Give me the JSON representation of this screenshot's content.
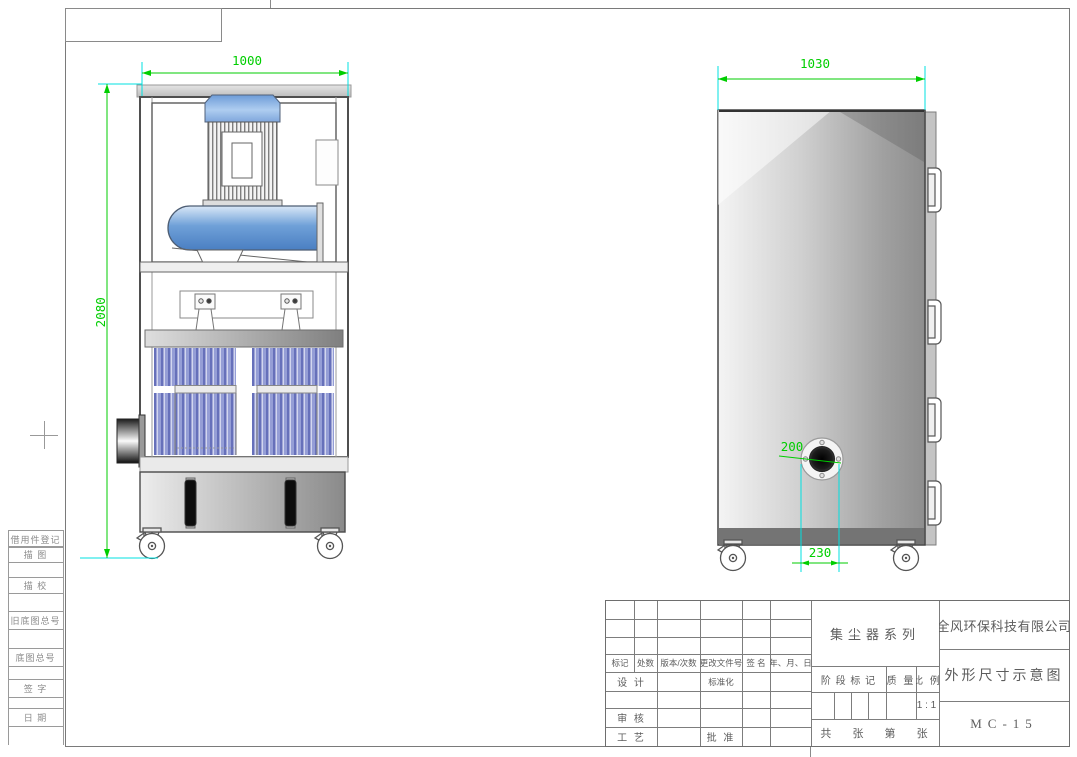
{
  "frame": {
    "margin_labels": [
      "借用件登记",
      "描 图",
      "描 校",
      "旧底图总号",
      "底图总号",
      "签 字",
      "日 期"
    ]
  },
  "dimensions": {
    "front_width": "1000",
    "front_height": "2080",
    "side_width": "1030",
    "inlet_diameter": "200",
    "inlet_offset": "230"
  },
  "title_block": {
    "rev_headers": [
      "标记",
      "处数",
      "版本/次数",
      "更改文件号",
      "签 名",
      "年、月、日"
    ],
    "design": "设 计",
    "standardization": "标准化",
    "review": "审 核",
    "process": "工 艺",
    "approve": "批 准",
    "series_title": "集尘器系列",
    "stage_mark": "阶 段 标 记",
    "mass": "质 量",
    "scale": "比 例",
    "scale_value": "1 : 1",
    "sheet_info": "共 张 第 张",
    "company": "全风环保科技有限公司",
    "drawing_title": "外形尺寸示意图",
    "model": "MC-15"
  },
  "colors": {
    "dimension_green": "#00ce00",
    "extension_cyan": "#00e0e0",
    "machine_blue": "#5b8fd0",
    "filter_blue": "#6670ba"
  }
}
